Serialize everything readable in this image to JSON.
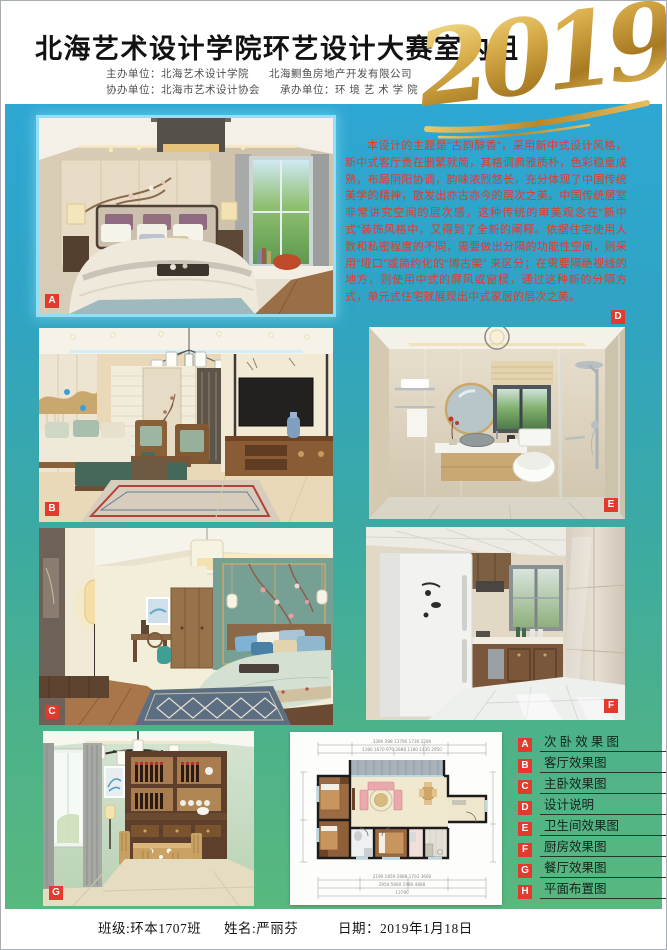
{
  "poster": {
    "title": "北海艺术设计学院环艺设计大赛室内组",
    "year": "2019"
  },
  "header": {
    "org1a": "主办单位：北海艺术设计学院",
    "org1b": "北海鲗鱼房地产开发有限公司",
    "org2a": "协办单位：北海市艺术设计协会",
    "org2b": "承办单位：环 境 艺 术 学 院"
  },
  "description": {
    "badge": "D",
    "text": "本设计的主题是“古韵醇香”，采用新中式设计风格，新中式客厅贵在删繁就简，其格调典雅质朴，色彩稳重成熟，布局阴阳协调，韵味浓烈悠长，充分体现了中国传统美学的精神，散发出亦古亦今的层次之美。中国传统居室非常讲究空间的层次感，这种传统的审美观念在“新中式”装饰风格中，又得到了全新的阐释。依据住宅使用人数和私密程度的不同，需要做出分隔的功能性空间，则采用“垭口”或简约化的“博古架”  来区分；在需要隔绝视线的地方，则使用中式的屏风或窗棂，通过这种新的分隔方式，单元式住宅就展现出中式家居的层次之美。"
  },
  "photos": {
    "a": {
      "badge": "A"
    },
    "b": {
      "badge": "B"
    },
    "c": {
      "badge": "C"
    },
    "e": {
      "badge": "E"
    },
    "f": {
      "badge": "F"
    },
    "g": {
      "badge": "G"
    }
  },
  "legend": {
    "items": [
      {
        "key": "A",
        "label": "次 卧 效 果 图"
      },
      {
        "key": "B",
        "label": "客厅效果图"
      },
      {
        "key": "C",
        "label": "主卧效果图"
      },
      {
        "key": "D",
        "label": "设计说明"
      },
      {
        "key": "E",
        "label": "卫生间效果图"
      },
      {
        "key": "F",
        "label": "厨房效果图"
      },
      {
        "key": "G",
        "label": "餐厅效果图"
      },
      {
        "key": "H",
        "label": "平面布置图"
      }
    ]
  },
  "floorplan": {
    "dims_top1": "3390    398    13790    1730    2280",
    "dims_top2": "1180   1670   970   2888   1180   1430   2950",
    "dims_bottom1": "2190   1859   2888   1703   3660",
    "dims_bottom2": "2950     5660     1980     4888",
    "dims_bottom3": "13790"
  },
  "footer": {
    "class_field": "班级:环本1707班",
    "name_field": "姓名:严丽芬",
    "date_field": "日期：2019年1月18日"
  },
  "colors": {
    "accent_red": "#e23a2c",
    "gold": "#cfa23e",
    "bg_top": "#2ea7d3",
    "bg_bottom": "#58b87e"
  }
}
